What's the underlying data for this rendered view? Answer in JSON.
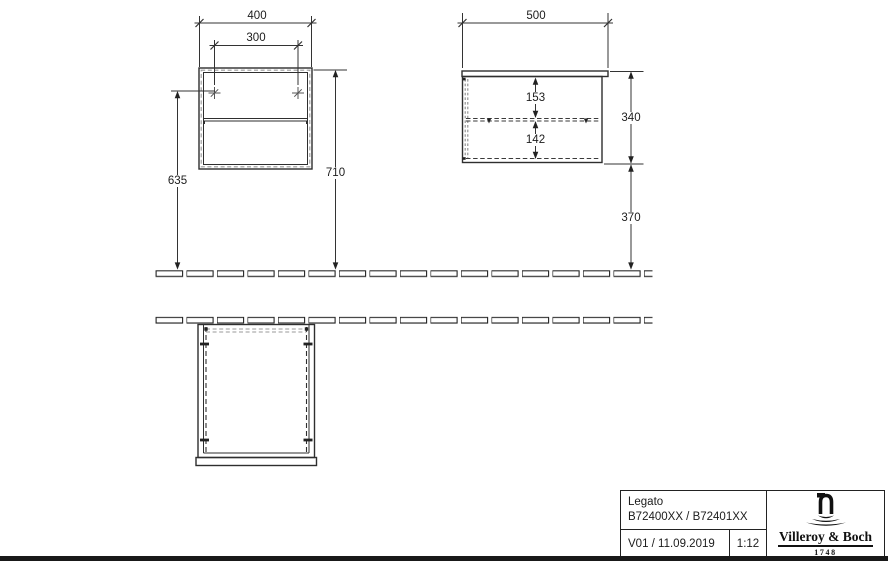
{
  "drawing": {
    "dimensions": {
      "front_width": "400",
      "front_hole_spacing": "300",
      "front_hole_height": "635",
      "front_total_height": "710",
      "side_depth": "500",
      "side_inner_top": "153",
      "side_inner_bottom": "142",
      "side_cabinet_height": "340",
      "side_floor_clearance": "370"
    }
  },
  "title_block": {
    "product_name": "Legato",
    "article_numbers": "B72400XX / B72401XX",
    "version_date": "V01 / 11.09.2019",
    "scale": "1:12",
    "brand_name": "Villeroy & Boch",
    "brand_year": "1748"
  },
  "icons": {
    "brand_logo": "villeroy-boch-fountain-icon"
  },
  "colors": {
    "line": "#2e2e2e",
    "dashed_gray": "#9a9a9a",
    "text": "#1c1c1c",
    "background": "#ffffff",
    "bottom_bar": "#191919"
  }
}
